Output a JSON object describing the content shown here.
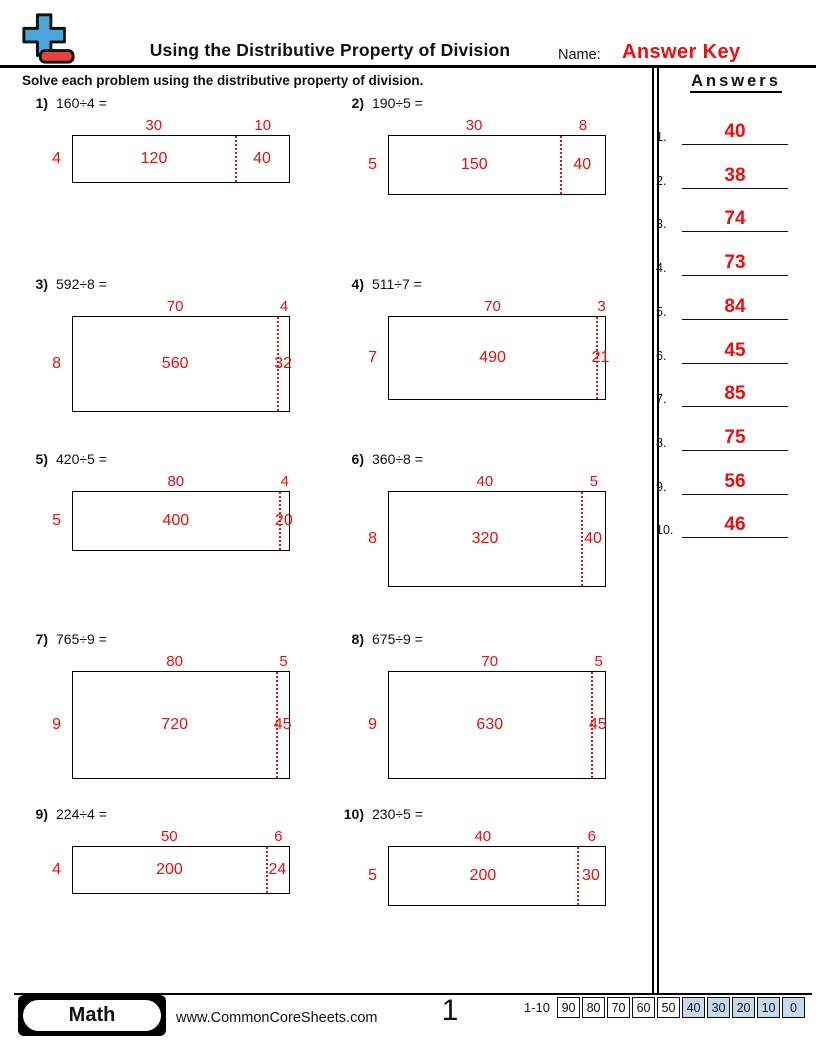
{
  "header": {
    "title": "Using the Distributive Property of Division",
    "name_label": "Name:",
    "name_value": "Answer Key",
    "instruction": "Solve each problem using the distributive property of division."
  },
  "icons": {
    "logo": "plus-minus-math-logo"
  },
  "colors": {
    "accent_red": "#f40b0b",
    "logo_plus_blue": "#4aa6d8",
    "logo_minus_red": "#e8423c",
    "score_highlight_blue": "#c7d9f1"
  },
  "problems": [
    {
      "number": "1)",
      "expression": "160÷4 =",
      "divisor": "4",
      "quotient_part_left": "30",
      "quotient_part_right": "10",
      "partial_left": "120",
      "partial_right": "40"
    },
    {
      "number": "2)",
      "expression": "190÷5 =",
      "divisor": "5",
      "quotient_part_left": "30",
      "quotient_part_right": "8",
      "partial_left": "150",
      "partial_right": "40"
    },
    {
      "number": "3)",
      "expression": "592÷8 =",
      "divisor": "8",
      "quotient_part_left": "70",
      "quotient_part_right": "4",
      "partial_left": "560",
      "partial_right": "32"
    },
    {
      "number": "4)",
      "expression": "511÷7 =",
      "divisor": "7",
      "quotient_part_left": "70",
      "quotient_part_right": "3",
      "partial_left": "490",
      "partial_right": "21"
    },
    {
      "number": "5)",
      "expression": "420÷5 =",
      "divisor": "5",
      "quotient_part_left": "80",
      "quotient_part_right": "4",
      "partial_left": "400",
      "partial_right": "20"
    },
    {
      "number": "6)",
      "expression": "360÷8 =",
      "divisor": "8",
      "quotient_part_left": "40",
      "quotient_part_right": "5",
      "partial_left": "320",
      "partial_right": "40"
    },
    {
      "number": "7)",
      "expression": "765÷9 =",
      "divisor": "9",
      "quotient_part_left": "80",
      "quotient_part_right": "5",
      "partial_left": "720",
      "partial_right": "45"
    },
    {
      "number": "8)",
      "expression": "675÷9 =",
      "divisor": "9",
      "quotient_part_left": "70",
      "quotient_part_right": "5",
      "partial_left": "630",
      "partial_right": "45"
    },
    {
      "number": "9)",
      "expression": "224÷4 =",
      "divisor": "4",
      "quotient_part_left": "50",
      "quotient_part_right": "6",
      "partial_left": "200",
      "partial_right": "24"
    },
    {
      "number": "10)",
      "expression": "230÷5 =",
      "divisor": "5",
      "quotient_part_left": "40",
      "quotient_part_right": "6",
      "partial_left": "200",
      "partial_right": "30"
    }
  ],
  "answers": {
    "title": "Answers",
    "items": [
      {
        "number": "1.",
        "value": "40"
      },
      {
        "number": "2.",
        "value": "38"
      },
      {
        "number": "3.",
        "value": "74"
      },
      {
        "number": "4.",
        "value": "73"
      },
      {
        "number": "5.",
        "value": "84"
      },
      {
        "number": "6.",
        "value": "45"
      },
      {
        "number": "7.",
        "value": "85"
      },
      {
        "number": "8.",
        "value": "75"
      },
      {
        "number": "9.",
        "value": "56"
      },
      {
        "number": "10.",
        "value": "46"
      }
    ]
  },
  "footer": {
    "subject": "Math",
    "website": "www.CommonCoreSheets.com",
    "page_number": "1",
    "score_label": "1-10",
    "score_cells": [
      {
        "value": "90",
        "highlighted": false
      },
      {
        "value": "80",
        "highlighted": false
      },
      {
        "value": "70",
        "highlighted": false
      },
      {
        "value": "60",
        "highlighted": false
      },
      {
        "value": "50",
        "highlighted": false
      },
      {
        "value": "40",
        "highlighted": true
      },
      {
        "value": "30",
        "highlighted": true
      },
      {
        "value": "20",
        "highlighted": true
      },
      {
        "value": "10",
        "highlighted": true
      },
      {
        "value": "0",
        "highlighted": true
      }
    ]
  }
}
